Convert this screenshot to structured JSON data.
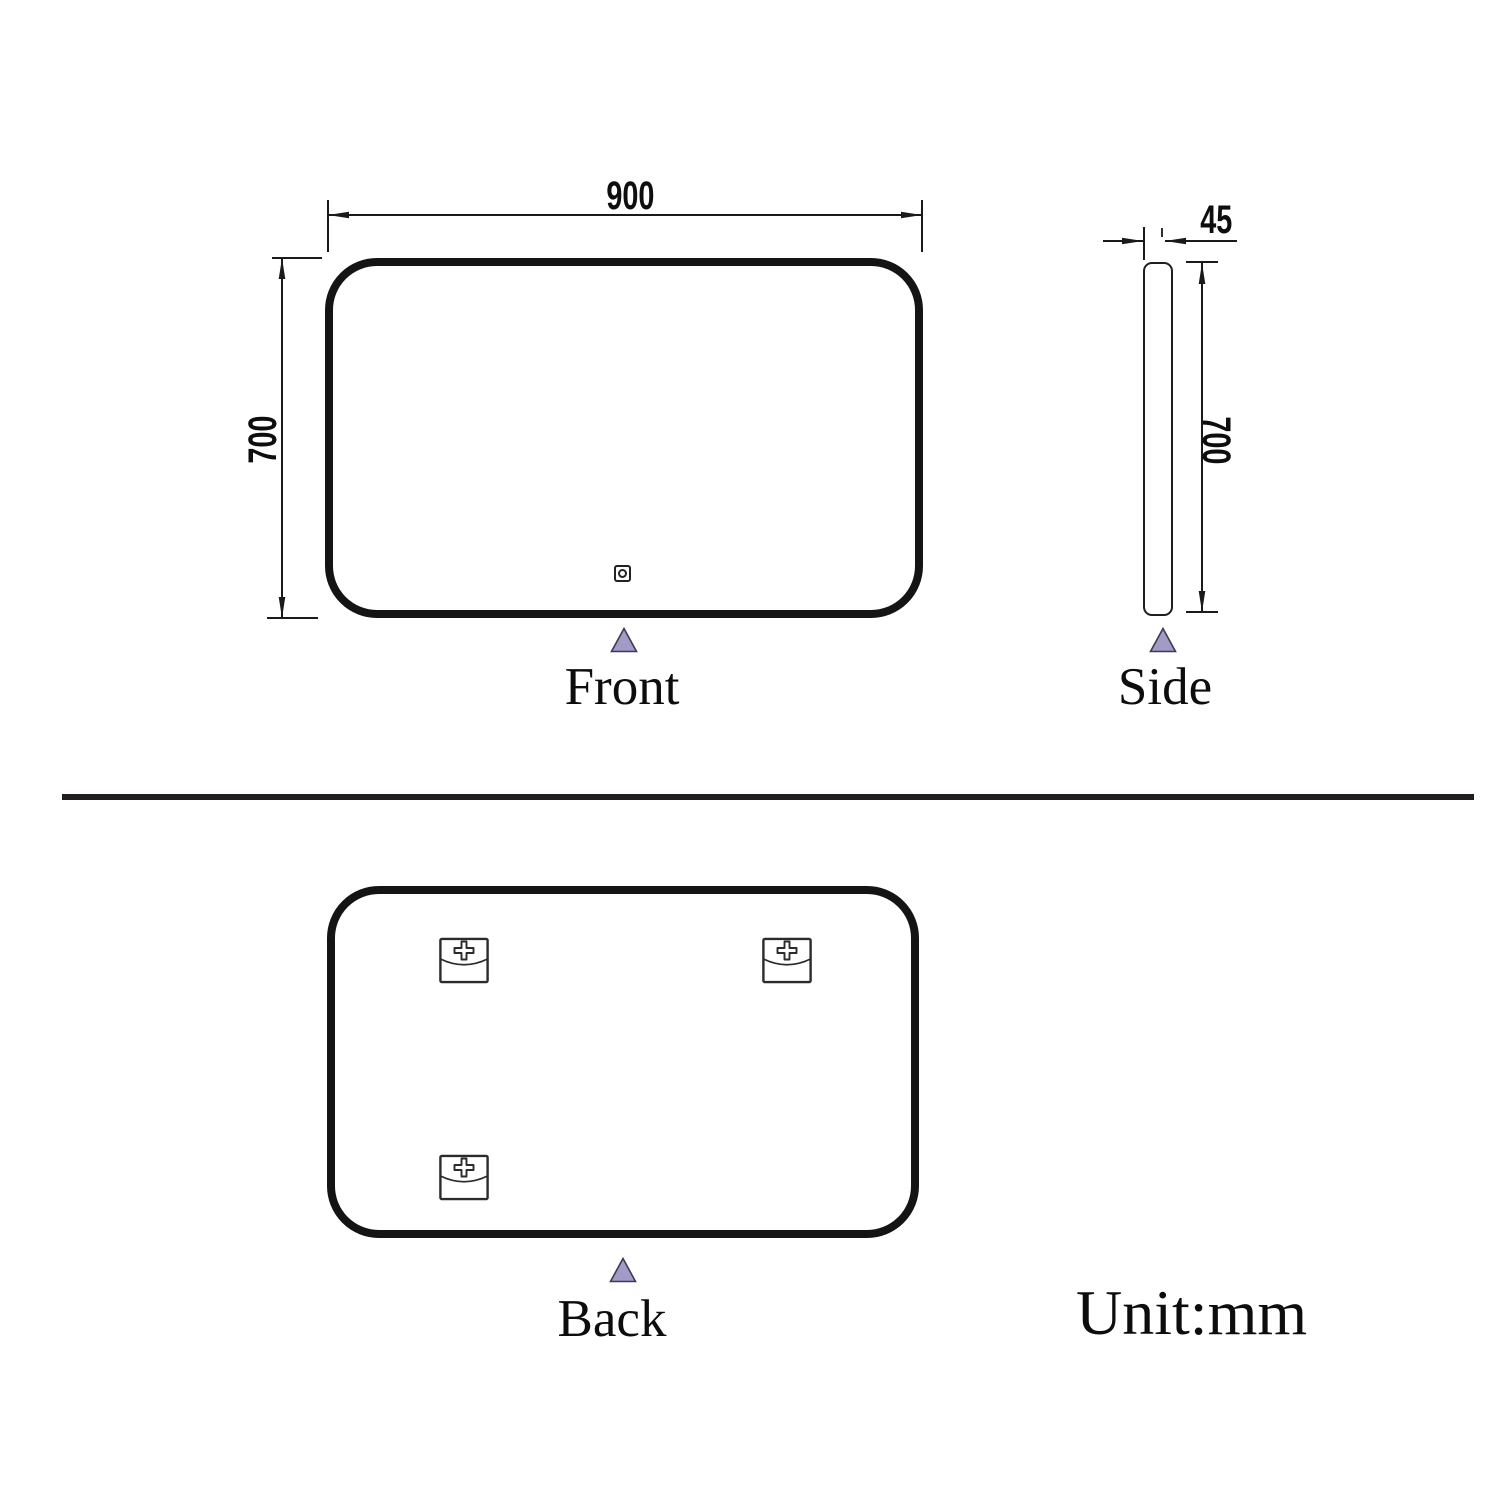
{
  "views": {
    "front": {
      "label": "Front",
      "width_mm": "900",
      "height_mm": "700"
    },
    "side": {
      "label": "Side",
      "thickness_mm": "45",
      "height_mm": "700"
    },
    "back": {
      "label": "Back"
    }
  },
  "unit_note": "Unit:mm",
  "colors": {
    "line": "#1a1a1a",
    "outline": "#141414",
    "triangle_fill": "#a19bc6",
    "triangle_stroke": "#3e3a56",
    "divider": "#231c1c"
  },
  "icons": {
    "touch_sensor": "touch-sensor-icon",
    "mounting_bracket": "mounting-bracket-icon",
    "view_pointer": "view-pointer-triangle-icon"
  }
}
